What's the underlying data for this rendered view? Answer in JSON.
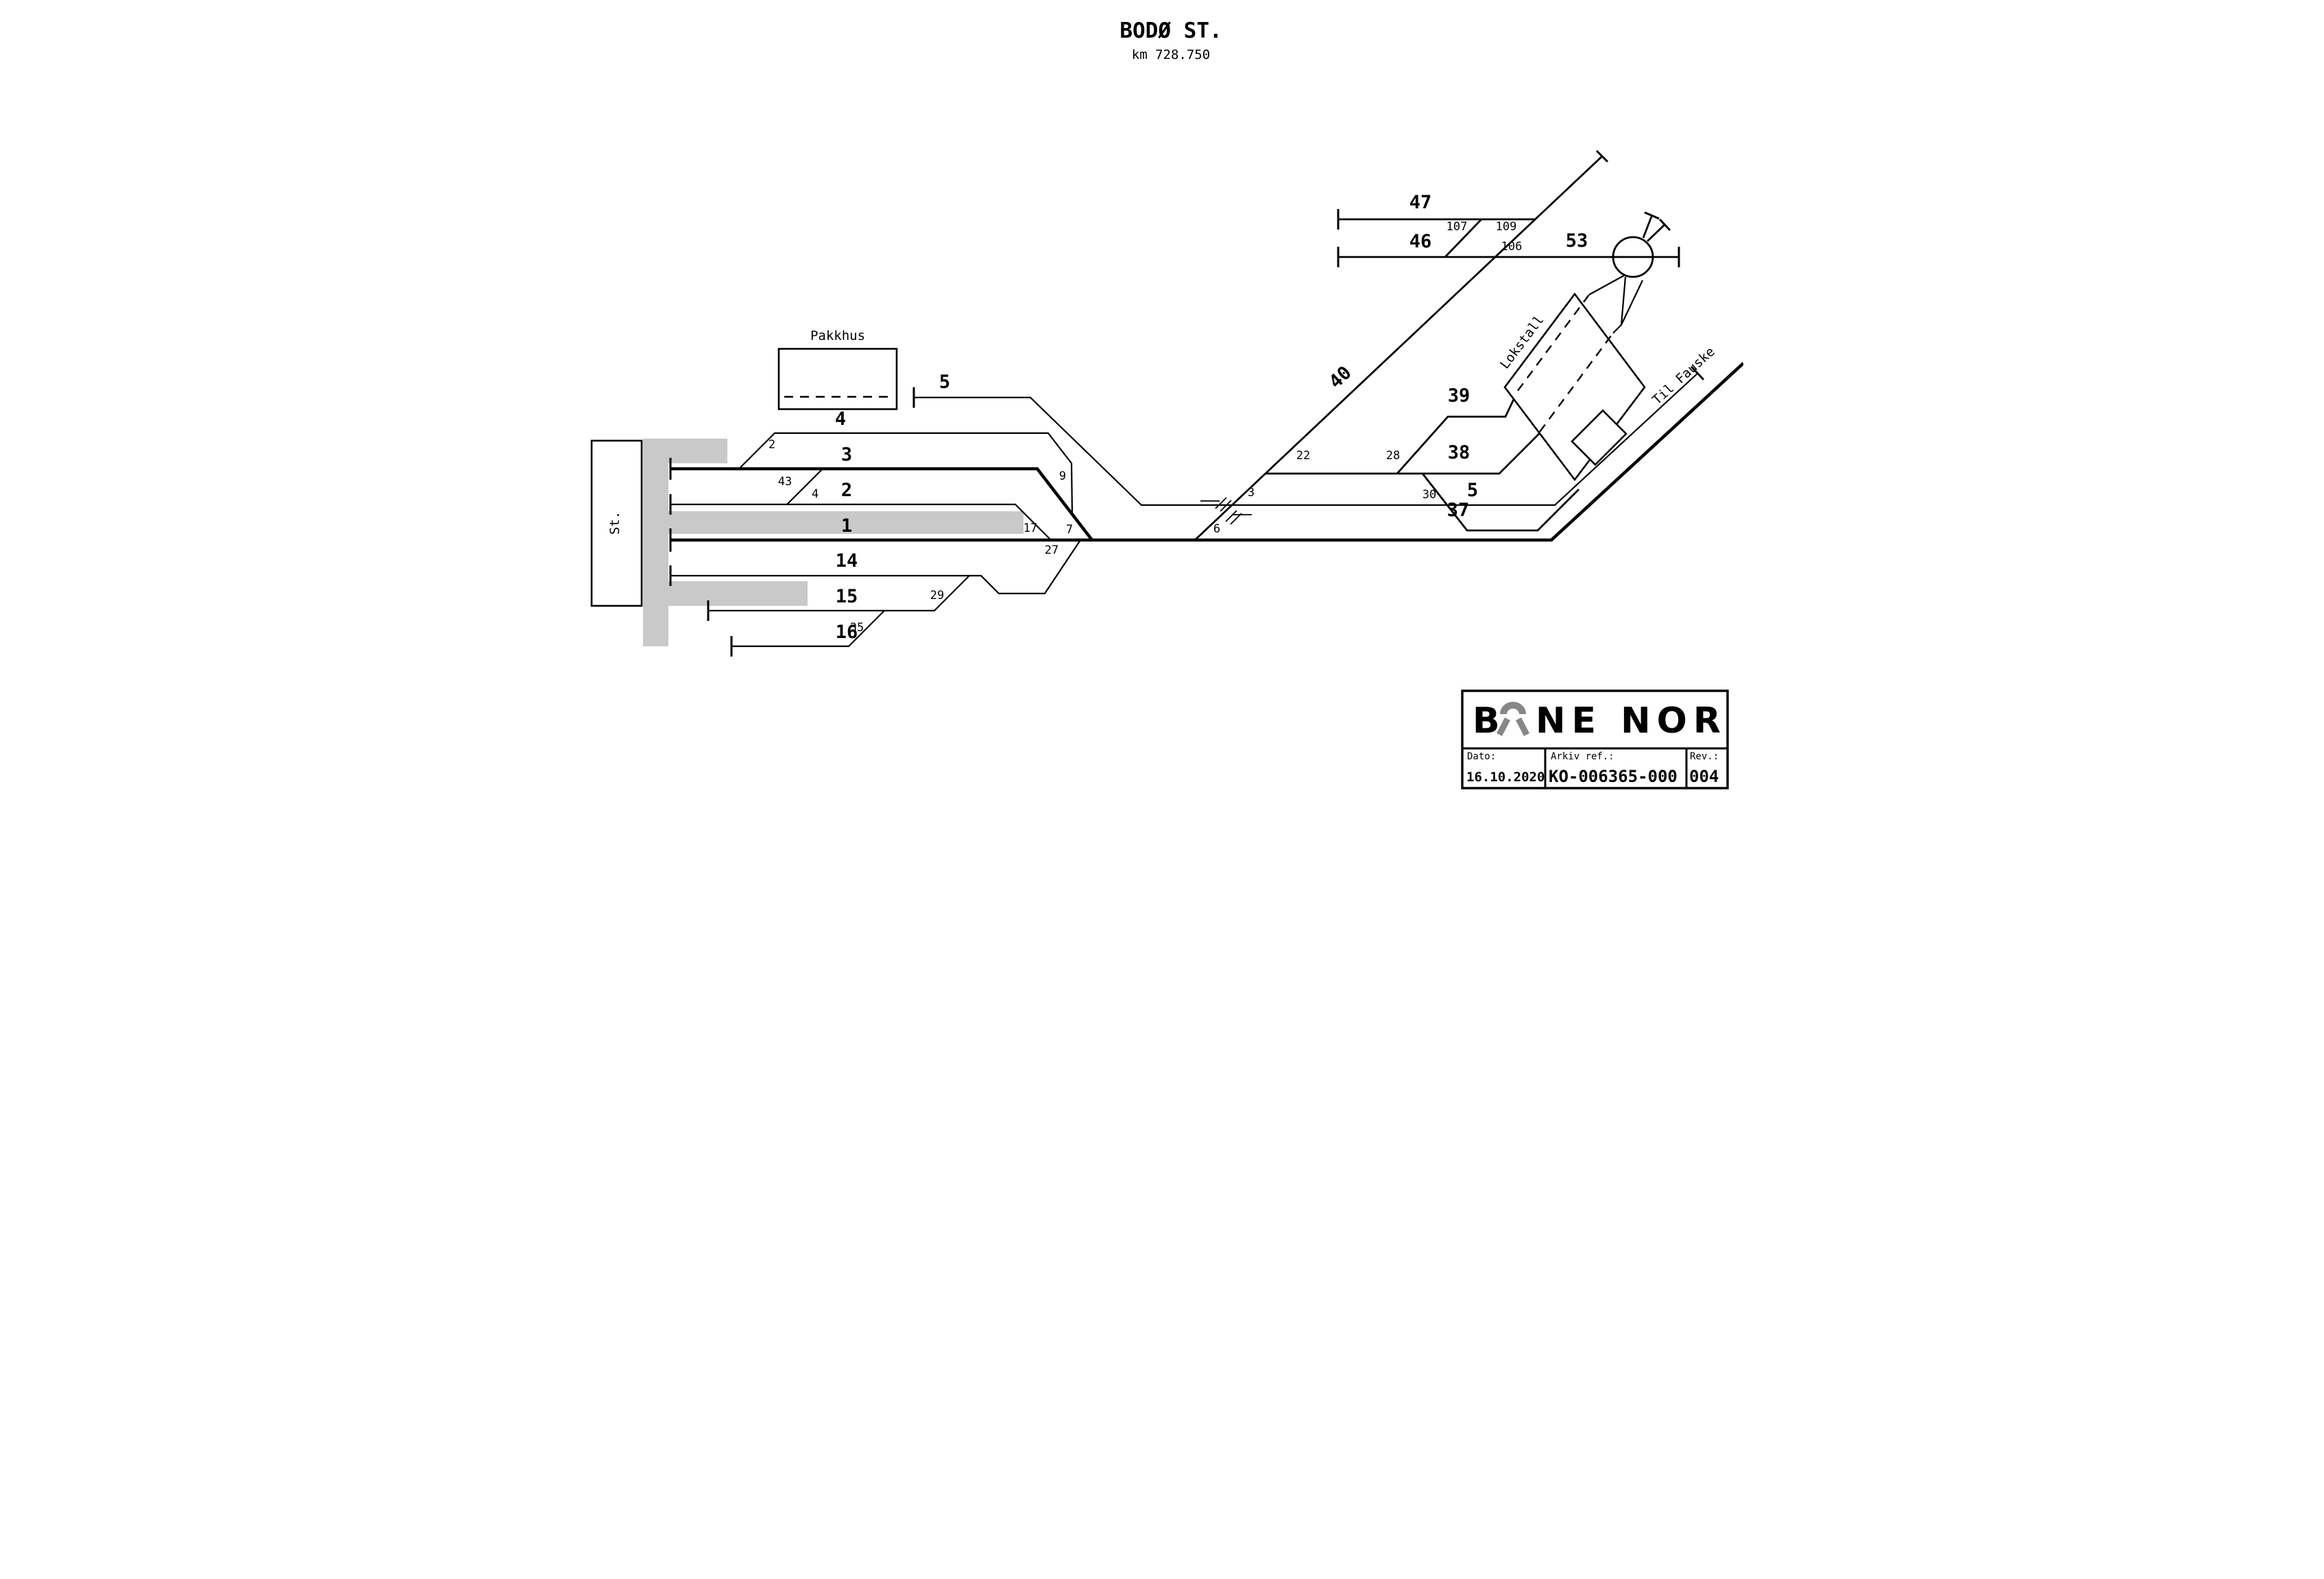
{
  "title": {
    "station": "BODØ ST.",
    "km": "km 728.750"
  },
  "labels": {
    "station_building": "St.",
    "pakkhus": "Pakkhus",
    "lokstall": "Lokstall",
    "til_fauske": "Til Fauske"
  },
  "tracks": {
    "t1": "1",
    "t2": "2",
    "t3": "3",
    "t4": "4",
    "t5_west": "5",
    "t5_east": "5",
    "t14": "14",
    "t15": "15",
    "t16": "16",
    "t37": "37",
    "t38": "38",
    "t39": "39",
    "t40": "40",
    "t46": "46",
    "t47": "47",
    "t53": "53"
  },
  "switches": {
    "s2": "2",
    "s3": "3",
    "s4": "4",
    "s6": "6",
    "s7": "7",
    "s9": "9",
    "s17": "17",
    "s22": "22",
    "s27": "27",
    "s28": "28",
    "s29": "29",
    "s30": "30",
    "s35": "35",
    "s43": "43",
    "s106": "106",
    "s107": "107",
    "s109": "109"
  },
  "title_block": {
    "logo_full": "BANE NOR",
    "logo_b": "B",
    "logo_rest": "NE NOR",
    "dato_label": "Dato:",
    "dato_value": "16.10.2020",
    "arkiv_label": "Arkiv ref.:",
    "arkiv_value": "KO-006365-000",
    "rev_label": "Rev.:",
    "rev_value": "004"
  },
  "colors": {
    "platform": "#c9c9c9",
    "logo_gray": "#878787",
    "line": "#000000",
    "background": "#ffffff"
  }
}
